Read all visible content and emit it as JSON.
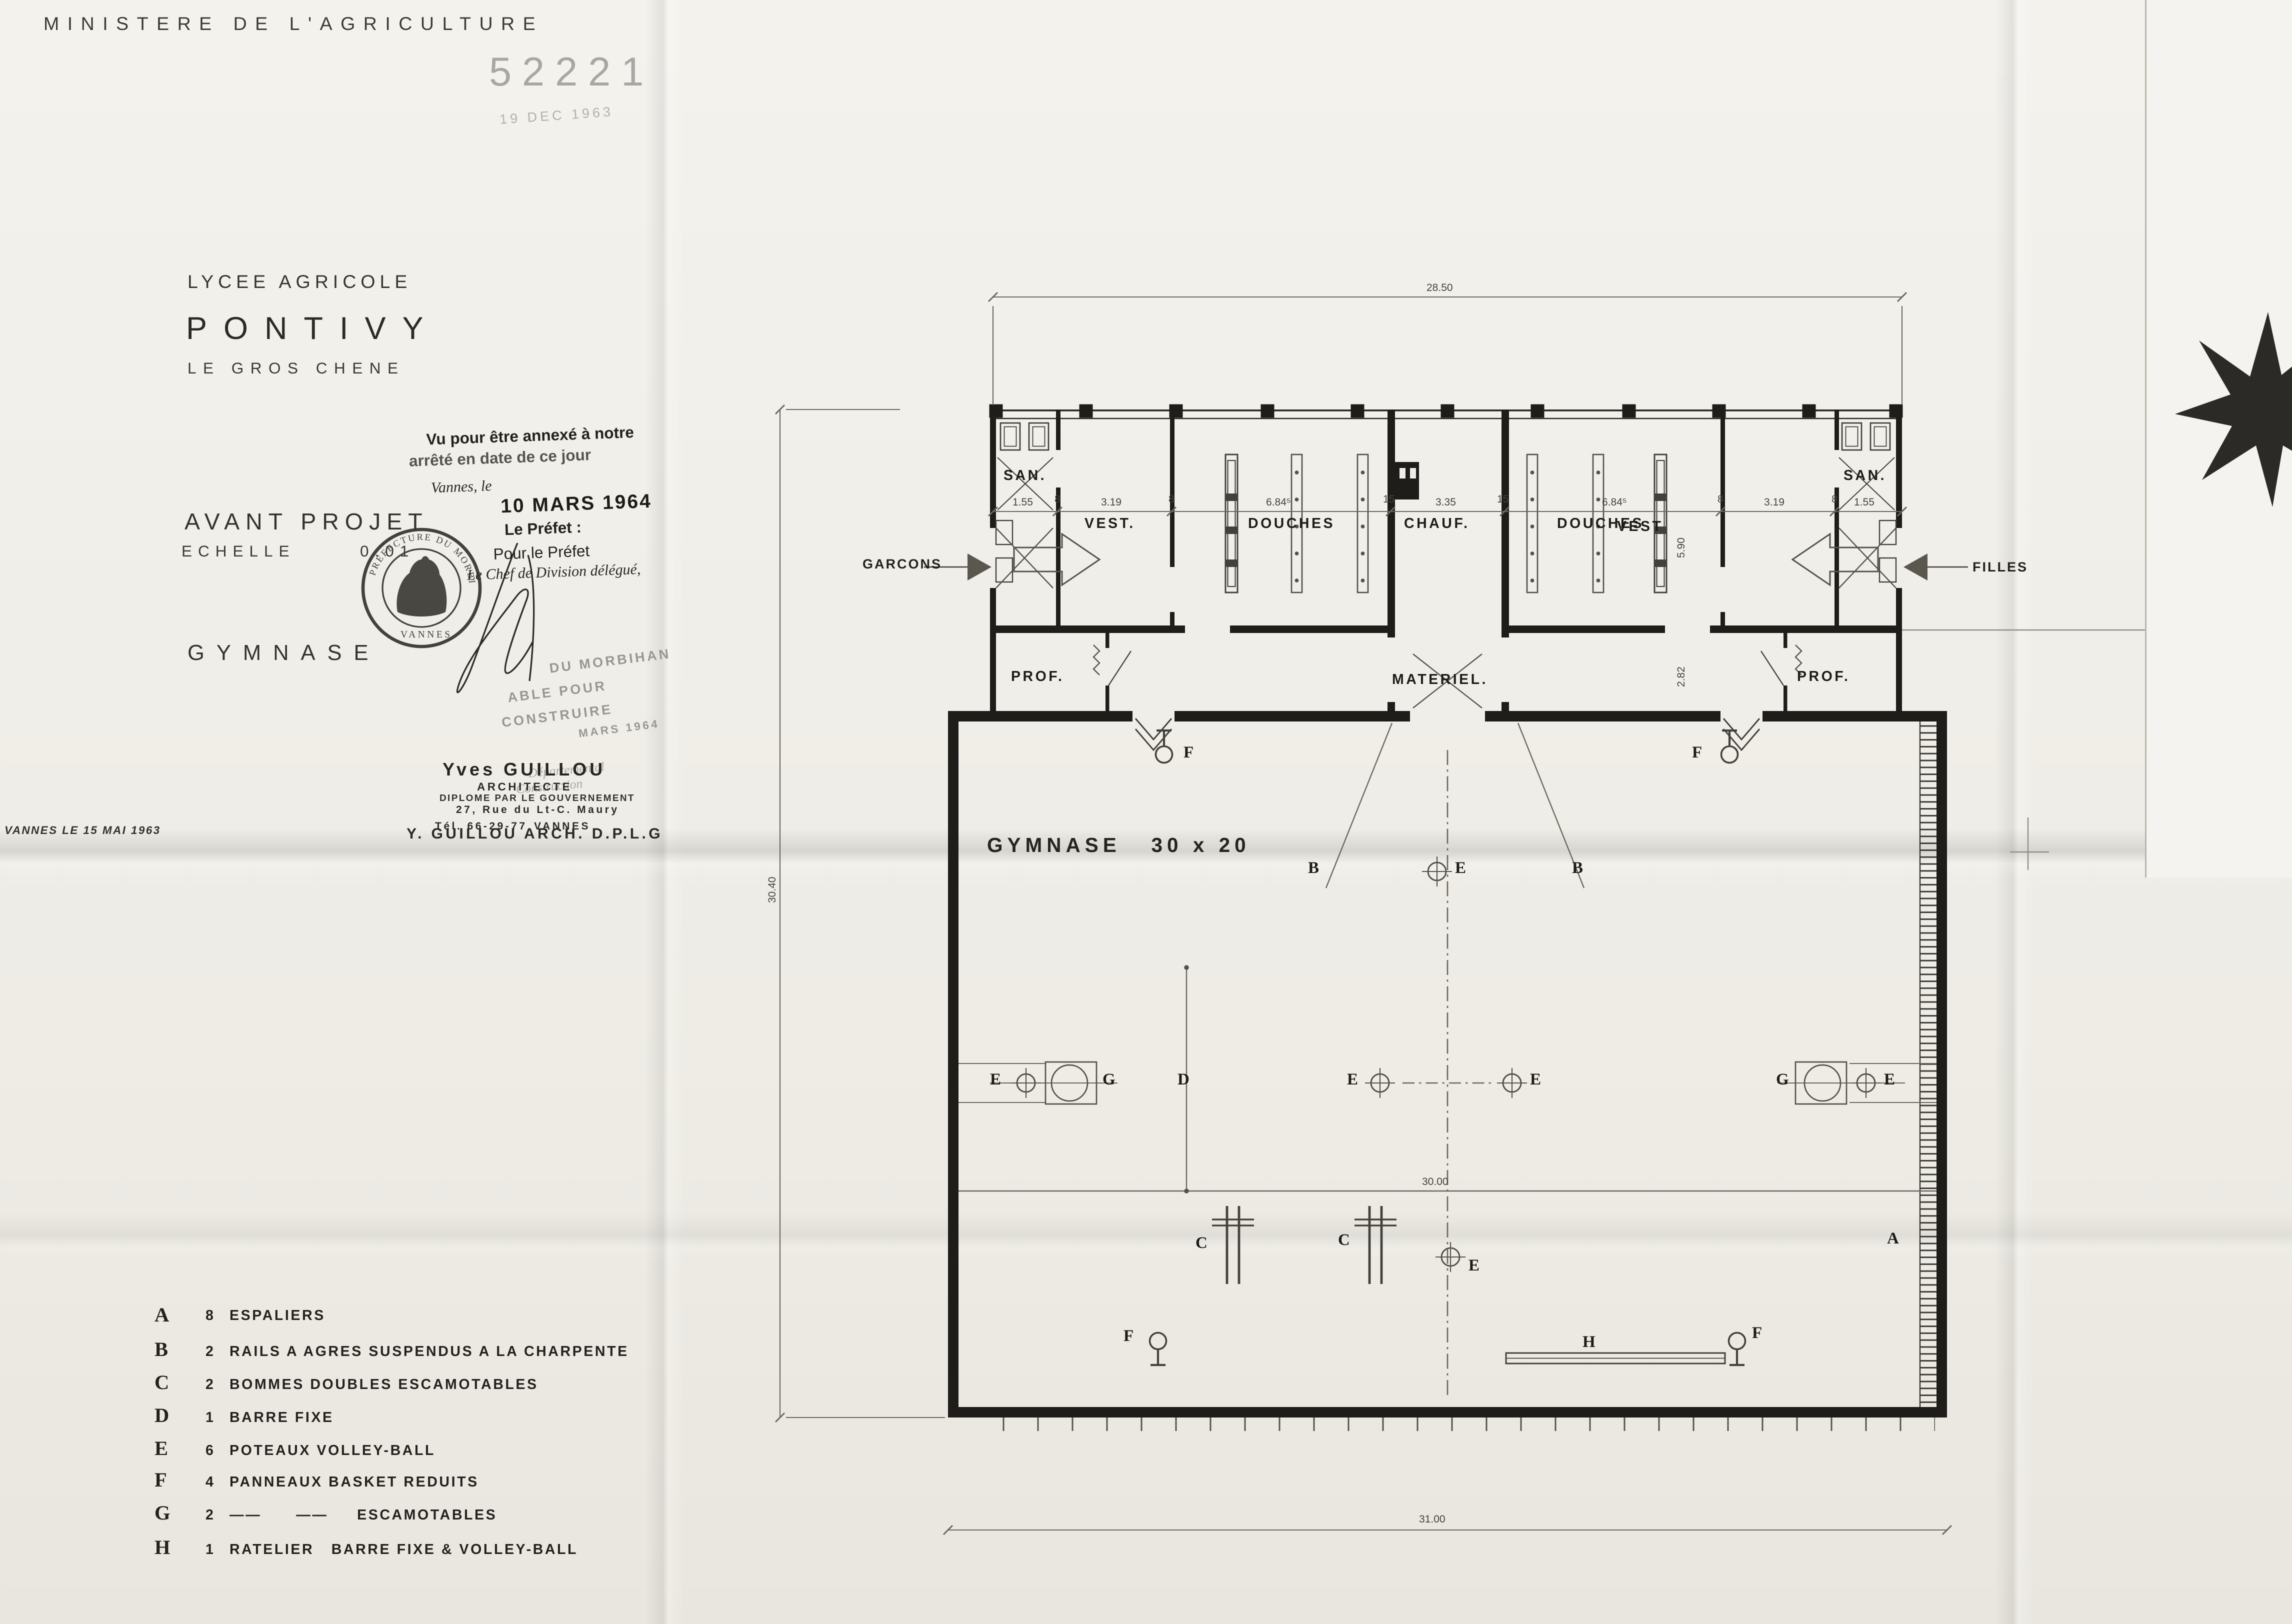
{
  "header": {
    "ministry": "MINISTERE DE L'AGRICULTURE"
  },
  "registry_stamp": {
    "number": "52221",
    "date": "19 DEC 1963"
  },
  "title_block": {
    "school_line1": "LYCEE AGRICOLE",
    "school_name": "PONTIVY",
    "school_line2": "LE GROS CHENE",
    "project": "AVANT PROJET",
    "scale_word": "ECHELLE",
    "scale_value": "0.01",
    "drawing": "GYMNASE"
  },
  "prefect_stamp": {
    "l1": "Vu pour être annexé à notre",
    "l2": "arrêté en date de ce jour",
    "l3": "Vannes, le",
    "date": "10 MARS 1964",
    "l4": "Le Préfet :",
    "l5": "Pour le Préfet",
    "l6": "Le Chef de Division délégué,"
  },
  "seal": {
    "arc": "PREFECTURE DU MORBIHAN",
    "bottom": "VANNES"
  },
  "approval_stamp": {
    "l1": "DU MORBIHAN",
    "l2": "ABLE POUR",
    "l3": "CONSTRUIRE",
    "l4": "MARS 1964",
    "l5": "Départemental",
    "l6": "Construction"
  },
  "architect": {
    "name": "Yves GUILLOU",
    "title": "ARCHITECTE",
    "diploma": "DIPLOME PAR LE GOUVERNEMENT",
    "address": "27, Rue du Lt-C. Maury",
    "phone": "Tél. 66-29-77",
    "city": "VANNES"
  },
  "footer": {
    "date_place": "VANNES LE 15 MAI 1963",
    "credit": "Y. GUILLOU ARCH. D.P.L.G"
  },
  "legend": {
    "items": [
      {
        "key": "A",
        "qty": "8",
        "label": "ESPALIERS"
      },
      {
        "key": "B",
        "qty": "2",
        "label": "RAILS A AGRES SUSPENDUS A LA CHARPENTE"
      },
      {
        "key": "C",
        "qty": "2",
        "label": "BOMMES DOUBLES ESCAMOTABLES"
      },
      {
        "key": "D",
        "qty": "1",
        "label": "BARRE FIXE"
      },
      {
        "key": "E",
        "qty": "6",
        "label": "POTEAUX VOLLEY-BALL"
      },
      {
        "key": "F",
        "qty": "4",
        "label": "PANNEAUX BASKET REDUITS"
      },
      {
        "key": "G",
        "qty": "2",
        "label": "——      ——     ESCAMOTABLES"
      },
      {
        "key": "H",
        "qty": "1",
        "label": "RATELIER   BARRE FIXE & VOLLEY-BALL"
      }
    ]
  },
  "plan": {
    "rooms": {
      "san_l": "SAN.",
      "vest_l": "VEST.",
      "douches_l": "DOUCHES",
      "chauf": "CHAUF.",
      "douches_r": "DOUCHES",
      "vest_r": "VEST",
      "san_r": "SAN.",
      "prof_l": "PROF.",
      "prof_r": "PROF.",
      "materiel": "MATERIEL.",
      "hall": "GYMNASE   30 x 20"
    },
    "doors": {
      "left": "GARCONS",
      "right": "FILLES"
    },
    "dims": {
      "top": "28.50",
      "left": "30.40",
      "mid": "30.00",
      "bottom": "31.00",
      "v1": "5.90",
      "v2": "2.82"
    },
    "chain": [
      "1.55",
      "8",
      "3.19",
      "8",
      "6.84⁵",
      "15",
      "3.35",
      "15",
      "6.84⁵",
      "8",
      "3.19",
      "8",
      "1.55"
    ],
    "markers": {
      "e1": "E",
      "g1": "G",
      "d1": "D",
      "e2": "E",
      "e3": "E",
      "g2": "G",
      "e4": "E",
      "b1": "B",
      "e5": "E",
      "b2": "B",
      "c1": "C",
      "c2": "C",
      "e6": "E",
      "a1": "A",
      "f1": "F",
      "f2": "F",
      "f3": "F",
      "f4": "F",
      "h1": "H"
    }
  }
}
